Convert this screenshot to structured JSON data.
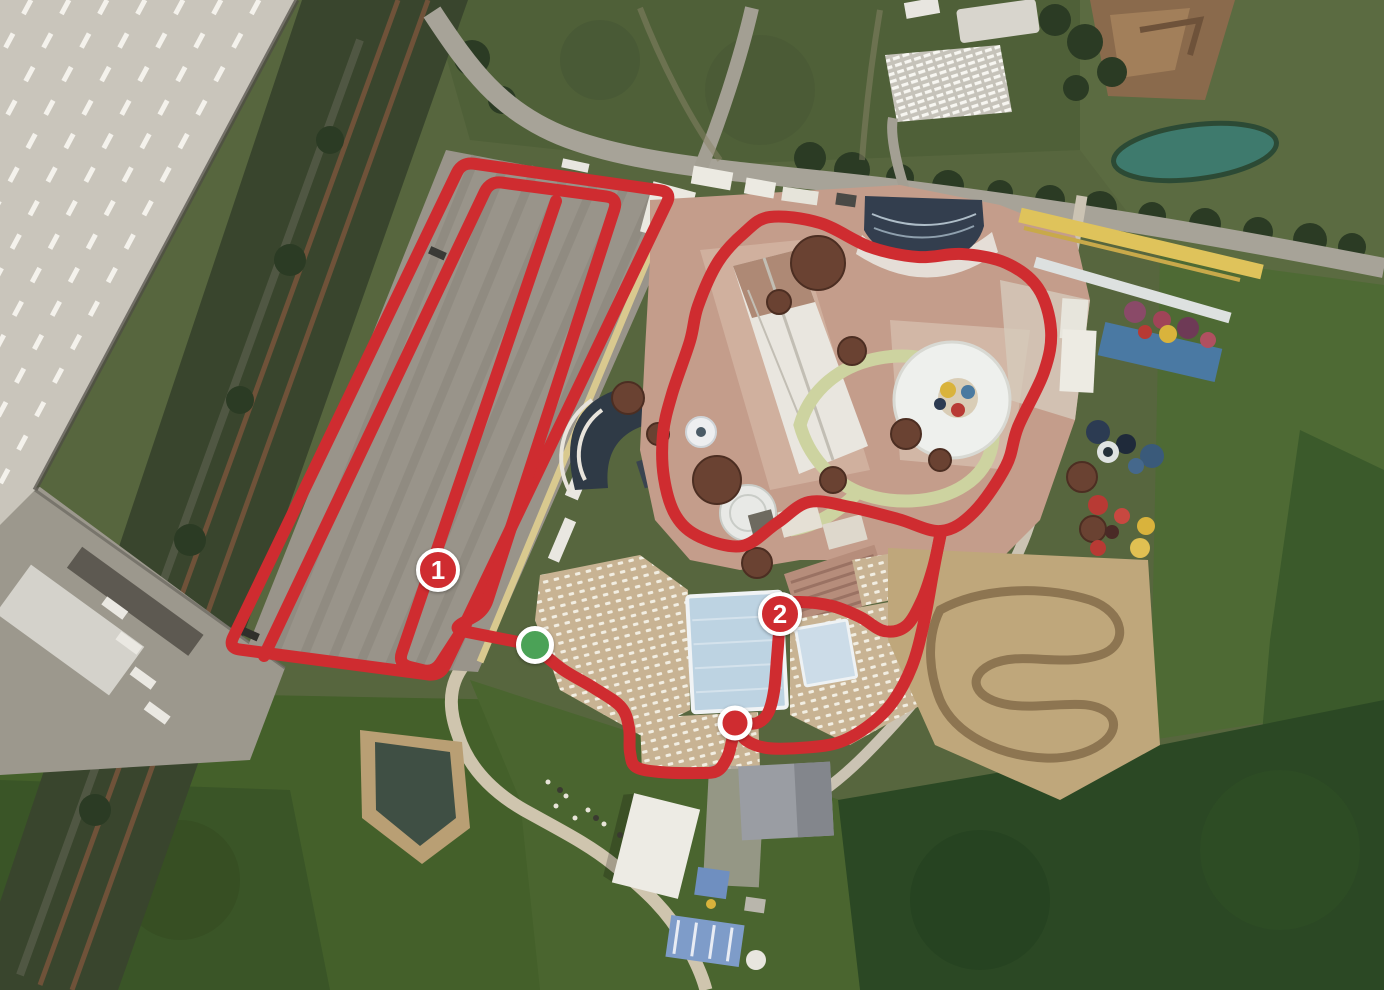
{
  "map": {
    "type": "satellite-route-map",
    "canvas": {
      "width": 1384,
      "height": 990
    },
    "route": {
      "color": "#cf2c30",
      "stroke_width": 12,
      "paths": [
        {
          "name": "parking-outer-loop",
          "style": "rounded",
          "closed": true,
          "points": [
            [
              228,
              648
            ],
            [
              462,
              162
            ],
            [
              672,
              192
            ],
            [
              440,
              676
            ]
          ]
        },
        {
          "name": "parking-middle-loop",
          "style": "rounded",
          "closed": false,
          "points": [
            [
              264,
              656
            ],
            [
              490,
              181
            ],
            [
              618,
              198
            ],
            [
              484,
              611
            ],
            [
              452,
              629
            ],
            [
              533,
              645
            ]
          ]
        },
        {
          "name": "parking-inner-line",
          "style": "rounded",
          "closed": false,
          "points": [
            [
              556,
              201
            ],
            [
              398,
              664
            ],
            [
              434,
              673
            ],
            [
              466,
              624
            ]
          ]
        },
        {
          "name": "waterpark-loop",
          "style": "smooth",
          "closed": true,
          "points": [
            [
              770,
              217
            ],
            [
              820,
              223
            ],
            [
              870,
              247
            ],
            [
              918,
              257
            ],
            [
              962,
              254
            ],
            [
              1006,
              263
            ],
            [
              1038,
              288
            ],
            [
              1051,
              330
            ],
            [
              1044,
              372
            ],
            [
              1018,
              427
            ],
            [
              1006,
              466
            ],
            [
              974,
              512
            ],
            [
              941,
              531
            ],
            [
              898,
              519
            ],
            [
              850,
              507
            ],
            [
              809,
              502
            ],
            [
              777,
              523
            ],
            [
              742,
              546
            ],
            [
              700,
              537
            ],
            [
              676,
              516
            ],
            [
              664,
              478
            ],
            [
              663,
              434
            ],
            [
              672,
              394
            ],
            [
              690,
              341
            ],
            [
              698,
              306
            ],
            [
              718,
              262
            ],
            [
              744,
              233
            ]
          ]
        },
        {
          "name": "exit-to-finish",
          "style": "smooth",
          "closed": false,
          "points": [
            [
              941,
              531
            ],
            [
              933,
              573
            ],
            [
              924,
              622
            ],
            [
              912,
              666
            ],
            [
              892,
              703
            ],
            [
              867,
              727
            ],
            [
              837,
              743
            ],
            [
              799,
              748
            ],
            [
              767,
              748
            ],
            [
              747,
              741
            ],
            [
              737,
              729
            ]
          ]
        },
        {
          "name": "marker2-connector",
          "style": "smooth",
          "closed": false,
          "points": [
            [
              737,
              724
            ],
            [
              757,
              723
            ],
            [
              768,
              713
            ],
            [
              774,
              691
            ],
            [
              777,
              658
            ],
            [
              780,
              622
            ],
            [
              783,
              605
            ],
            [
              800,
              602
            ],
            [
              832,
              606
            ],
            [
              860,
              617
            ],
            [
              884,
              631
            ],
            [
              906,
              626
            ],
            [
              922,
              600
            ],
            [
              933,
              568
            ],
            [
              941,
              533
            ]
          ]
        },
        {
          "name": "start-approach",
          "style": "smooth",
          "closed": false,
          "points": [
            [
              533,
              645
            ],
            [
              562,
              669
            ],
            [
              594,
              688
            ],
            [
              621,
              707
            ],
            [
              629,
              728
            ],
            [
              630,
              752
            ],
            [
              636,
              767
            ],
            [
              660,
              772
            ],
            [
              698,
              773
            ],
            [
              717,
              771
            ],
            [
              727,
              758
            ],
            [
              732,
              741
            ],
            [
              735,
              727
            ]
          ]
        }
      ]
    },
    "markers": {
      "waypoints": [
        {
          "id": "waypoint-1",
          "label": "1",
          "x": 438,
          "y": 570,
          "fill": "#cf2c30"
        },
        {
          "id": "waypoint-2",
          "label": "2",
          "x": 780,
          "y": 614,
          "fill": "#cf2c30"
        }
      ],
      "start": {
        "id": "start",
        "x": 535,
        "y": 645,
        "fill": "#4ba257"
      },
      "finish": {
        "id": "finish",
        "x": 735,
        "y": 723,
        "fill": "#cf2c30"
      }
    }
  }
}
